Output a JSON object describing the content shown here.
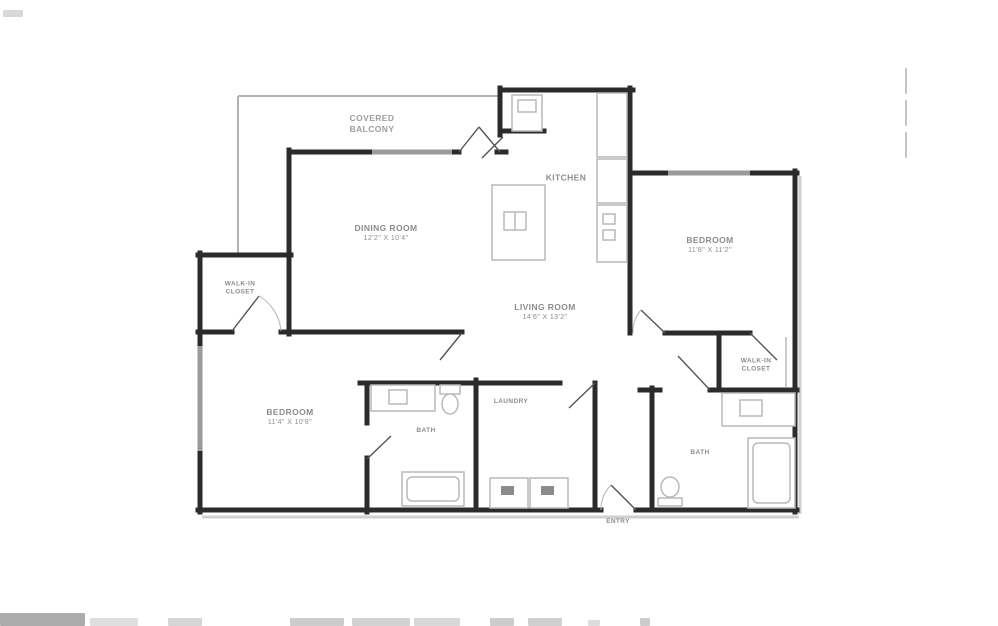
{
  "floor_plan": {
    "balcony": {
      "line1": "COVERED",
      "line2": "BALCONY"
    },
    "kitchen": {
      "name": "KITCHEN"
    },
    "dining": {
      "name": "DINING ROOM",
      "dims": "12'2\" X 10'4\""
    },
    "living": {
      "name": "LIVING ROOM",
      "dims": "14'6\" X 13'2\""
    },
    "bedroom1": {
      "name": "BEDROOM",
      "dims": "11'8\" X 11'2\""
    },
    "bedroom2": {
      "name": "BEDROOM",
      "dims": "11'4\" X 10'8\""
    },
    "bath1": {
      "name": "BATH"
    },
    "bath2": {
      "name": "BATH"
    },
    "laundry": {
      "name": "LAUNDRY"
    },
    "wic1": {
      "line1": "WALK-IN",
      "line2": "CLOSET"
    },
    "wic2": {
      "line1": "WALK-IN",
      "line2": "CLOSET"
    },
    "entry": {
      "name": "ENTRY"
    },
    "colors": {
      "wall": "#2b2b2b",
      "window": "#9a9a9a",
      "fixture": "#b9b9b9",
      "label": "#8c8c8c",
      "balcony_line": "#b3b3b3"
    }
  }
}
